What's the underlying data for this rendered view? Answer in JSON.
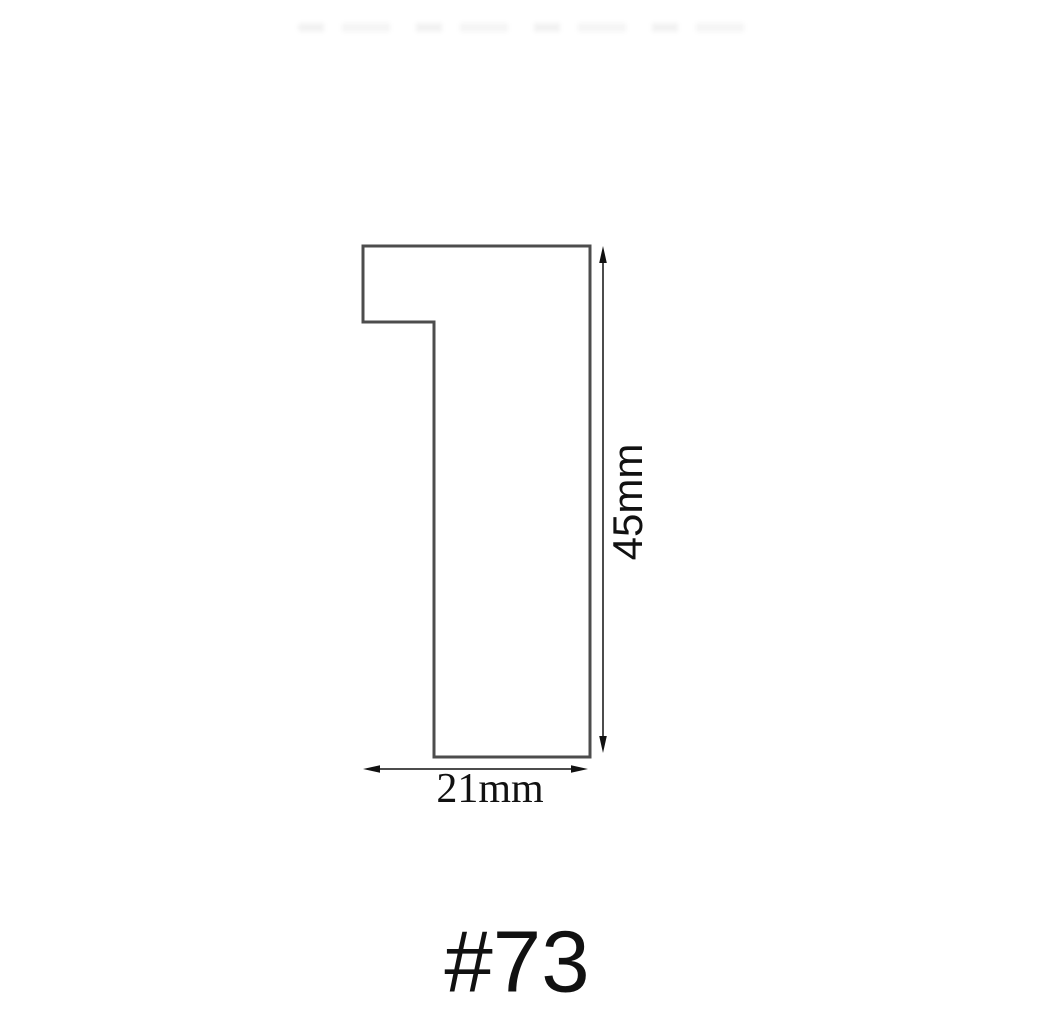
{
  "diagram": {
    "labels": {
      "height": "45mm",
      "width": "21mm",
      "model": "#73"
    },
    "colors": {
      "background": "#ffffff",
      "profile_outline": "#4d4d4d",
      "profile_fill": "#ffffff",
      "dimension": "#111111",
      "text": "#111111"
    }
  }
}
